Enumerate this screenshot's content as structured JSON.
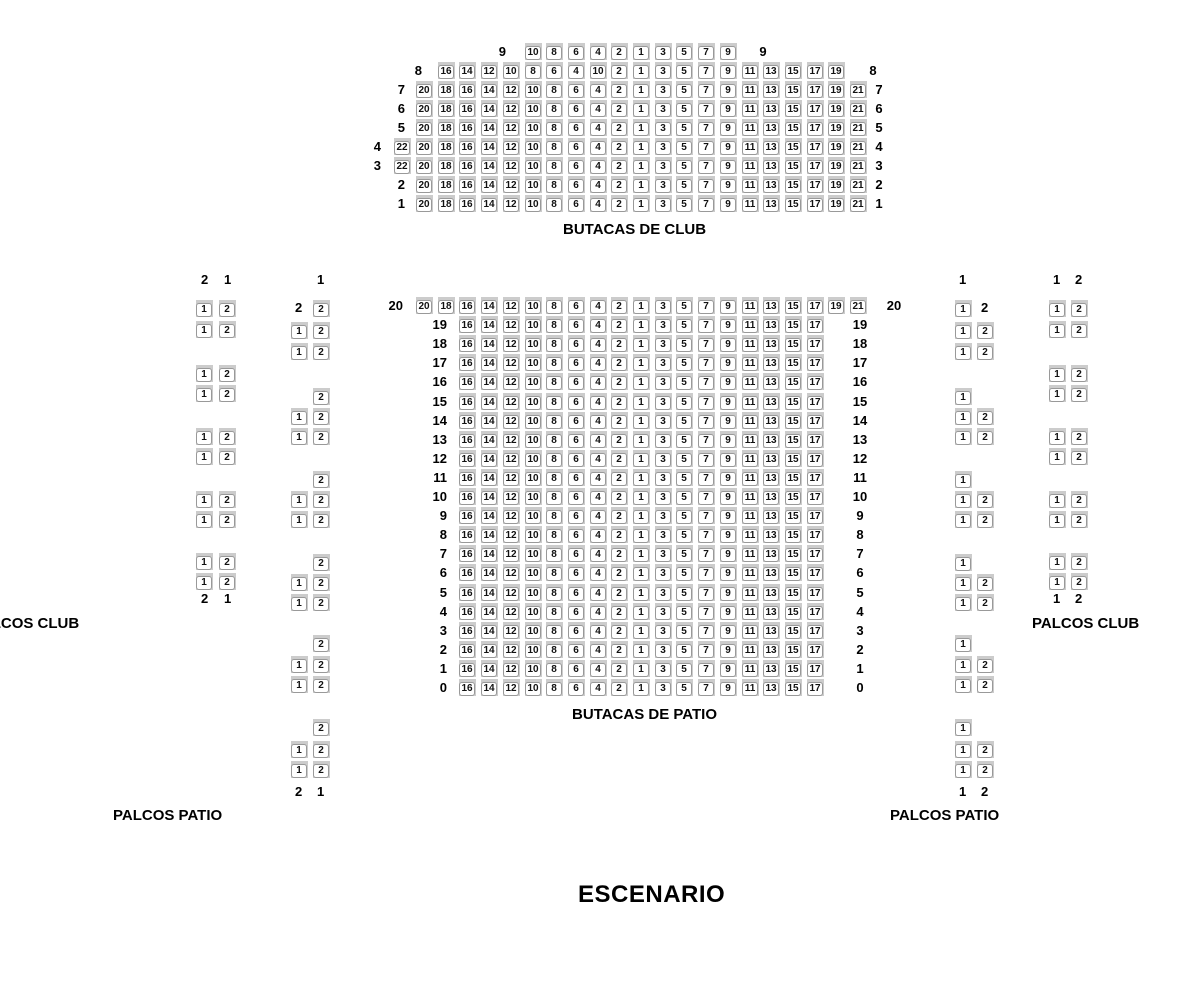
{
  "labels": {
    "butacas_club": "BUTACAS DE CLUB",
    "butacas_patio": "BUTACAS DE PATIO",
    "palcos_club_left": "PALCOS CLUB",
    "palcos_club_right": "PALCOS CLUB",
    "palcos_patio_left": "PALCOS PATIO",
    "palcos_patio_right": "PALCOS PATIO",
    "stage": "ESCENARIO"
  },
  "colors": {
    "background": "#ffffff",
    "seat_base": "#cccccc",
    "seat_plate": "#ffffff",
    "seat_border": "#999999",
    "label_text": "#000000"
  },
  "seat_patterns": {
    "row9": [
      "10",
      "8",
      "6",
      "4",
      "2",
      "1",
      "3",
      "5",
      "7",
      "9"
    ],
    "row8": [
      "16",
      "14",
      "12",
      "10",
      "8",
      "6",
      "4",
      "10",
      "2",
      "1",
      "3",
      "5",
      "7",
      "9",
      "11",
      "13",
      "15",
      "17",
      "19"
    ],
    "c21": [
      "20",
      "18",
      "16",
      "14",
      "12",
      "10",
      "8",
      "6",
      "4",
      "2",
      "1",
      "3",
      "5",
      "7",
      "9",
      "11",
      "13",
      "15",
      "17",
      "19",
      "21"
    ],
    "c22": [
      "22",
      "20",
      "18",
      "16",
      "14",
      "12",
      "10",
      "8",
      "6",
      "4",
      "2",
      "1",
      "3",
      "5",
      "7",
      "9",
      "11",
      "13",
      "15",
      "17",
      "19",
      "21"
    ],
    "p17": [
      "16",
      "14",
      "12",
      "10",
      "8",
      "6",
      "4",
      "2",
      "1",
      "3",
      "5",
      "7",
      "9",
      "11",
      "13",
      "15",
      "17"
    ]
  },
  "grids": [
    {
      "name": "butacas-de-club",
      "origin_x": 416,
      "origin_y": 43,
      "pitch_x": 21.7,
      "pitch_y": 19,
      "rows": [
        {
          "label": "9",
          "start_col": 5,
          "pattern": "row9",
          "left_x": 484,
          "right_x": 753
        },
        {
          "label": "8",
          "start_col": 1,
          "pattern": "row8",
          "left_x": 400,
          "right_x": 863
        },
        {
          "label": "7",
          "start_col": 0,
          "pattern": "c21",
          "left_x": 383,
          "right_x": 869
        },
        {
          "label": "6",
          "start_col": 0,
          "pattern": "c21",
          "left_x": 383,
          "right_x": 869
        },
        {
          "label": "5",
          "start_col": 0,
          "pattern": "c21",
          "left_x": 383,
          "right_x": 869
        },
        {
          "label": "4",
          "start_col": -1,
          "pattern": "c22",
          "left_x": 359,
          "right_x": 869
        },
        {
          "label": "3",
          "start_col": -1,
          "pattern": "c22",
          "left_x": 359,
          "right_x": 869
        },
        {
          "label": "2",
          "start_col": 0,
          "pattern": "c21",
          "left_x": 383,
          "right_x": 869
        },
        {
          "label": "1",
          "start_col": 0,
          "pattern": "c21",
          "left_x": 383,
          "right_x": 869
        }
      ]
    },
    {
      "name": "butacas-de-patio",
      "origin_x": 416,
      "origin_y": 297,
      "pitch_x": 21.7,
      "pitch_y": 19.1,
      "rows": [
        {
          "label": "20",
          "start_col": 0,
          "pattern": "c21",
          "left_x": 381,
          "right_x": 884
        },
        {
          "label": "19",
          "start_col": 2,
          "pattern": "p17",
          "left_x": 425,
          "right_x": 850
        },
        {
          "label": "18",
          "start_col": 2,
          "pattern": "p17",
          "left_x": 425,
          "right_x": 850
        },
        {
          "label": "17",
          "start_col": 2,
          "pattern": "p17",
          "left_x": 425,
          "right_x": 850
        },
        {
          "label": "16",
          "start_col": 2,
          "pattern": "p17",
          "left_x": 425,
          "right_x": 850
        },
        {
          "label": "15",
          "start_col": 2,
          "pattern": "p17",
          "left_x": 425,
          "right_x": 850
        },
        {
          "label": "14",
          "start_col": 2,
          "pattern": "p17",
          "left_x": 425,
          "right_x": 850
        },
        {
          "label": "13",
          "start_col": 2,
          "pattern": "p17",
          "left_x": 425,
          "right_x": 850
        },
        {
          "label": "12",
          "start_col": 2,
          "pattern": "p17",
          "left_x": 425,
          "right_x": 850
        },
        {
          "label": "11",
          "start_col": 2,
          "pattern": "p17",
          "left_x": 425,
          "right_x": 850
        },
        {
          "label": "10",
          "start_col": 2,
          "pattern": "p17",
          "left_x": 425,
          "right_x": 850
        },
        {
          "label": "9",
          "start_col": 2,
          "pattern": "p17",
          "left_x": 425,
          "right_x": 850
        },
        {
          "label": "8",
          "start_col": 2,
          "pattern": "p17",
          "left_x": 425,
          "right_x": 850
        },
        {
          "label": "7",
          "start_col": 2,
          "pattern": "p17",
          "left_x": 425,
          "right_x": 850
        },
        {
          "label": "6",
          "start_col": 2,
          "pattern": "p17",
          "left_x": 425,
          "right_x": 850
        },
        {
          "label": "5",
          "start_col": 2,
          "pattern": "p17",
          "left_x": 425,
          "right_x": 850
        },
        {
          "label": "4",
          "start_col": 2,
          "pattern": "p17",
          "left_x": 425,
          "right_x": 850
        },
        {
          "label": "3",
          "start_col": 2,
          "pattern": "p17",
          "left_x": 425,
          "right_x": 850
        },
        {
          "label": "2",
          "start_col": 2,
          "pattern": "p17",
          "left_x": 425,
          "right_x": 850
        },
        {
          "label": "1",
          "start_col": 2,
          "pattern": "p17",
          "left_x": 425,
          "right_x": 850
        },
        {
          "label": "0",
          "start_col": 2,
          "pattern": "p17",
          "left_x": 425,
          "right_x": 850
        }
      ]
    }
  ],
  "palco_columns": [
    {
      "name": "palcos-club-left",
      "seat_x": [
        196,
        219
      ],
      "header_y": 273,
      "header": [
        {
          "x": 201,
          "t": "2"
        },
        {
          "x": 224,
          "t": "1"
        }
      ],
      "footer_y": 592,
      "footer": [
        {
          "x": 201,
          "t": "2"
        },
        {
          "x": 224,
          "t": "1"
        }
      ],
      "rows": [
        {
          "y": 300,
          "seats": [
            "1",
            "2"
          ]
        },
        {
          "y": 321,
          "seats": [
            "1",
            "2"
          ]
        },
        {
          "y": 365,
          "seats": [
            "1",
            "2"
          ]
        },
        {
          "y": 385,
          "seats": [
            "1",
            "2"
          ]
        },
        {
          "y": 428,
          "seats": [
            "1",
            "2"
          ]
        },
        {
          "y": 448,
          "seats": [
            "1",
            "2"
          ]
        },
        {
          "y": 491,
          "seats": [
            "1",
            "2"
          ]
        },
        {
          "y": 511,
          "seats": [
            "1",
            "2"
          ]
        },
        {
          "y": 553,
          "seats": [
            "1",
            "2"
          ]
        },
        {
          "y": 573,
          "seats": [
            "1",
            "2"
          ]
        }
      ]
    },
    {
      "name": "palcos-patio-left",
      "seat_x": [
        291,
        313
      ],
      "header_y": 273,
      "header": [
        {
          "x": 317,
          "t": "1"
        }
      ],
      "footer_y": 785,
      "footer": [
        {
          "x": 295,
          "t": "2"
        },
        {
          "x": 317,
          "t": "1"
        }
      ],
      "rows": [
        {
          "y": 300,
          "seats": [
            "",
            "2"
          ],
          "inline": {
            "x": 295,
            "t": "2"
          }
        },
        {
          "y": 322,
          "seats": [
            "1",
            "2"
          ]
        },
        {
          "y": 343,
          "seats": [
            "1",
            "2"
          ]
        },
        {
          "y": 388,
          "seats": [
            "",
            "2"
          ]
        },
        {
          "y": 408,
          "seats": [
            "1",
            "2"
          ]
        },
        {
          "y": 428,
          "seats": [
            "1",
            "2"
          ]
        },
        {
          "y": 471,
          "seats": [
            "",
            "2"
          ]
        },
        {
          "y": 491,
          "seats": [
            "1",
            "2"
          ]
        },
        {
          "y": 511,
          "seats": [
            "1",
            "2"
          ]
        },
        {
          "y": 554,
          "seats": [
            "",
            "2"
          ]
        },
        {
          "y": 574,
          "seats": [
            "1",
            "2"
          ]
        },
        {
          "y": 594,
          "seats": [
            "1",
            "2"
          ]
        },
        {
          "y": 635,
          "seats": [
            "",
            "2"
          ]
        },
        {
          "y": 656,
          "seats": [
            "1",
            "2"
          ]
        },
        {
          "y": 676,
          "seats": [
            "1",
            "2"
          ]
        },
        {
          "y": 719,
          "seats": [
            "",
            "2"
          ]
        },
        {
          "y": 741,
          "seats": [
            "1",
            "2"
          ]
        },
        {
          "y": 761,
          "seats": [
            "1",
            "2"
          ]
        }
      ]
    },
    {
      "name": "palcos-patio-right",
      "seat_x": [
        955,
        977
      ],
      "header_y": 273,
      "header": [
        {
          "x": 959,
          "t": "1"
        }
      ],
      "footer_y": 785,
      "footer": [
        {
          "x": 959,
          "t": "1"
        },
        {
          "x": 981,
          "t": "2"
        }
      ],
      "rows": [
        {
          "y": 300,
          "seats": [
            "1",
            ""
          ],
          "inline": {
            "x": 981,
            "t": "2"
          }
        },
        {
          "y": 322,
          "seats": [
            "1",
            "2"
          ]
        },
        {
          "y": 343,
          "seats": [
            "1",
            "2"
          ]
        },
        {
          "y": 388,
          "seats": [
            "1",
            ""
          ]
        },
        {
          "y": 408,
          "seats": [
            "1",
            "2"
          ]
        },
        {
          "y": 428,
          "seats": [
            "1",
            "2"
          ]
        },
        {
          "y": 471,
          "seats": [
            "1",
            ""
          ]
        },
        {
          "y": 491,
          "seats": [
            "1",
            "2"
          ]
        },
        {
          "y": 511,
          "seats": [
            "1",
            "2"
          ]
        },
        {
          "y": 554,
          "seats": [
            "1",
            ""
          ]
        },
        {
          "y": 574,
          "seats": [
            "1",
            "2"
          ]
        },
        {
          "y": 594,
          "seats": [
            "1",
            "2"
          ]
        },
        {
          "y": 635,
          "seats": [
            "1",
            ""
          ]
        },
        {
          "y": 656,
          "seats": [
            "1",
            "2"
          ]
        },
        {
          "y": 676,
          "seats": [
            "1",
            "2"
          ]
        },
        {
          "y": 719,
          "seats": [
            "1",
            ""
          ]
        },
        {
          "y": 741,
          "seats": [
            "1",
            "2"
          ]
        },
        {
          "y": 761,
          "seats": [
            "1",
            "2"
          ]
        }
      ]
    },
    {
      "name": "palcos-club-right",
      "seat_x": [
        1049,
        1071
      ],
      "header_y": 273,
      "header": [
        {
          "x": 1053,
          "t": "1"
        },
        {
          "x": 1075,
          "t": "2"
        }
      ],
      "footer_y": 592,
      "footer": [
        {
          "x": 1053,
          "t": "1"
        },
        {
          "x": 1075,
          "t": "2"
        }
      ],
      "rows": [
        {
          "y": 300,
          "seats": [
            "1",
            "2"
          ]
        },
        {
          "y": 321,
          "seats": [
            "1",
            "2"
          ]
        },
        {
          "y": 365,
          "seats": [
            "1",
            "2"
          ]
        },
        {
          "y": 385,
          "seats": [
            "1",
            "2"
          ]
        },
        {
          "y": 428,
          "seats": [
            "1",
            "2"
          ]
        },
        {
          "y": 448,
          "seats": [
            "1",
            "2"
          ]
        },
        {
          "y": 491,
          "seats": [
            "1",
            "2"
          ]
        },
        {
          "y": 511,
          "seats": [
            "1",
            "2"
          ]
        },
        {
          "y": 553,
          "seats": [
            "1",
            "2"
          ]
        },
        {
          "y": 573,
          "seats": [
            "1",
            "2"
          ]
        }
      ]
    }
  ]
}
